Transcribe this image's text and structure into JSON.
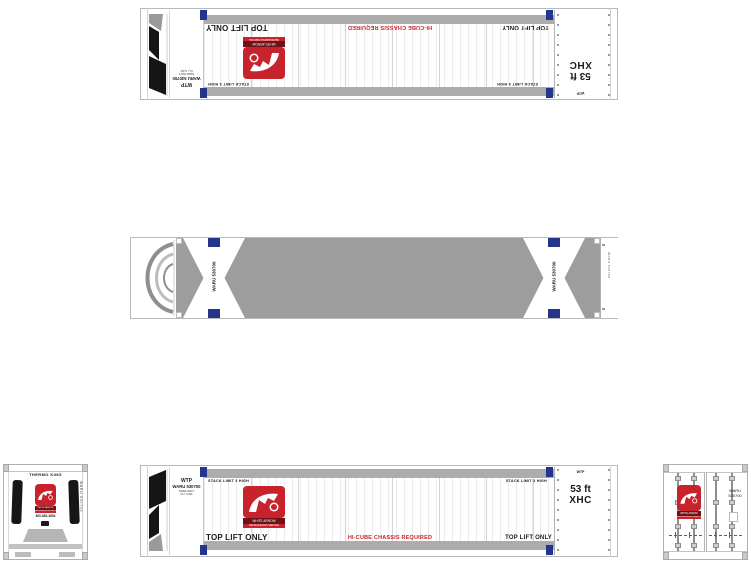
{
  "colors": {
    "red": "#c8232c",
    "dark_red": "#6d1216",
    "marker_blue": "#26358c",
    "rail_gray": "#acacac",
    "roof_gray": "#9d9d9d"
  },
  "side_view": {
    "stack_limit_label": "STACK LIMIT 3 HIGH",
    "top_lift_label": "TOP LIFT ONLY",
    "hi_cube_label": "HI-CUBE CHASSIS REQUIRED",
    "unit_panel": {
      "owner_code": "WTP",
      "container_number": "WARU 530700",
      "tare_line": "TARE WGT",
      "cube_line": "CU. CAP."
    },
    "door_panel": {
      "owner_code": "WTP",
      "length_label": "53 ft",
      "height_code": "XHC"
    }
  },
  "logo": {
    "caption": "WHITE ARROW",
    "subcaption": "REFRIGERATED SERVICE"
  },
  "roof_view": {
    "lift_zone_number": "WARU 530700",
    "edge_number": "WARU 530700"
  },
  "front_end": {
    "brand": "THERMO KING",
    "phone": "800-853-4854",
    "side_number": "WARU 530700"
  },
  "door_end": {
    "number_line1": "WARU",
    "number_line2": "530700"
  }
}
